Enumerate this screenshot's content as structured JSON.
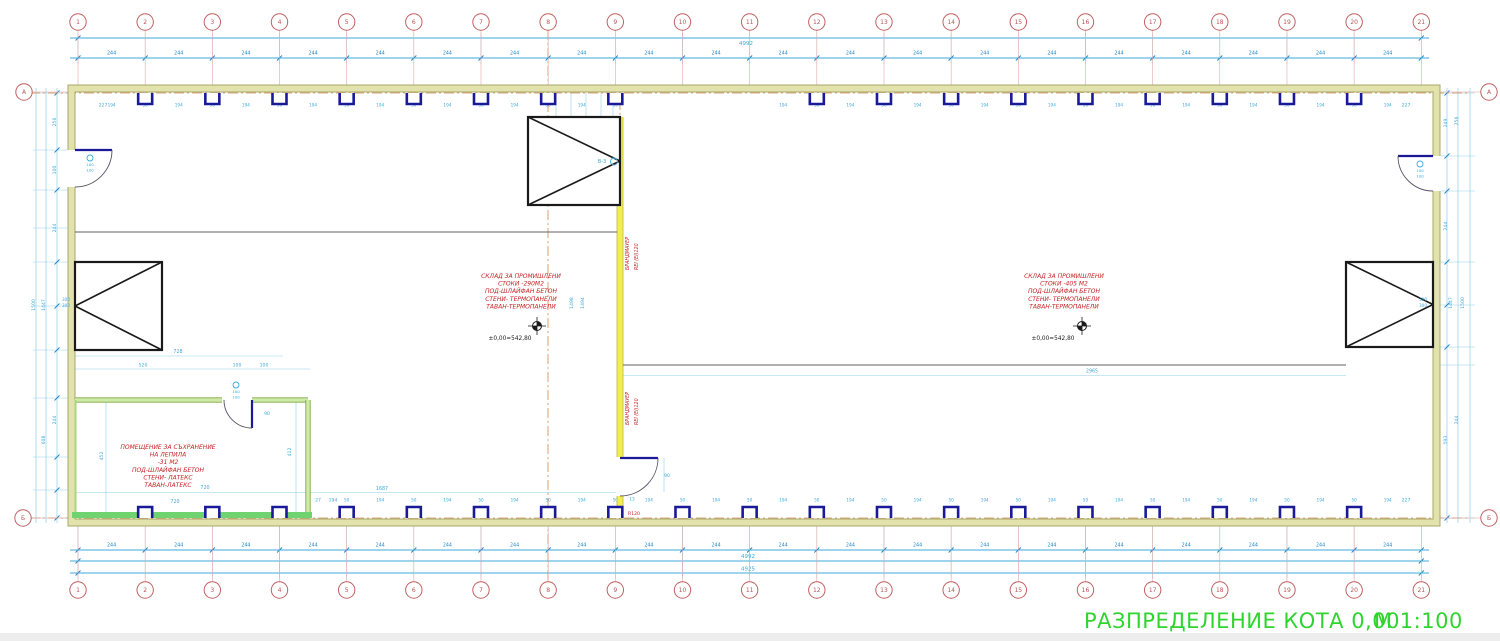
{
  "title": {
    "text": "РАЗПРЕДЕЛЕНИЕ КОТА 0,00",
    "scale": "М 1:100"
  },
  "grid": {
    "columns": [
      "1",
      "2",
      "3",
      "4",
      "5",
      "6",
      "7",
      "8",
      "9",
      "10",
      "11",
      "12",
      "13",
      "14",
      "15",
      "16",
      "17",
      "18",
      "19",
      "20",
      "21"
    ],
    "row_top": "А",
    "row_bottom": "Б"
  },
  "dims": {
    "bay": "244",
    "overall_top": "4992",
    "overall_bottom_1": "4992",
    "overall_bottom_2": "4925",
    "column_width": "50",
    "column_gap": "194",
    "misc": [
      {
        "t": "4992",
        "x": 746,
        "y": 45,
        "s": 5.5
      },
      {
        "t": "4992",
        "x": 748,
        "y": 558,
        "s": 5.5
      },
      {
        "t": "4925",
        "x": 748,
        "y": 570.5,
        "s": 5.5
      },
      {
        "t": "227",
        "x": 103,
        "y": 106.5,
        "s": 4.6
      },
      {
        "t": "227",
        "x": 1406,
        "y": 106.5,
        "s": 4.6
      },
      {
        "t": "227",
        "x": 1406,
        "y": 501.5,
        "s": 4.6
      },
      {
        "t": "27",
        "x": 318,
        "y": 501.5,
        "s": 4.6
      },
      {
        "t": "194",
        "x": 333,
        "y": 501.5,
        "s": 4.6
      },
      {
        "t": "1687",
        "x": 382,
        "y": 490,
        "s": 4.8
      },
      {
        "t": "720",
        "x": 175,
        "y": 503,
        "s": 4.8
      },
      {
        "t": "728",
        "x": 178,
        "y": 353,
        "s": 4.8
      },
      {
        "t": "520",
        "x": 143,
        "y": 366.5,
        "s": 4.6
      },
      {
        "t": "100",
        "x": 237,
        "y": 366.5,
        "s": 4.6
      },
      {
        "t": "100",
        "x": 264,
        "y": 366.5,
        "s": 4.6
      },
      {
        "t": "720",
        "x": 205,
        "y": 489,
        "s": 4.8
      },
      {
        "t": "90",
        "x": 267,
        "y": 415,
        "s": 4.6
      },
      {
        "t": "90",
        "x": 667,
        "y": 477,
        "s": 4.6
      },
      {
        "t": "13",
        "x": 632,
        "y": 500.5,
        "s": 4.2
      },
      {
        "t": "2965",
        "x": 1092,
        "y": 372.5,
        "s": 4.8
      },
      {
        "t": "R120",
        "x": 766,
        "y": 91,
        "s": 4.6,
        "c": "red"
      },
      {
        "t": "R120",
        "x": 634,
        "y": 515,
        "s": 4.6,
        "c": "red"
      },
      {
        "t": "1500",
        "x": 35,
        "y": 305,
        "r": -90
      },
      {
        "t": "1447",
        "x": 45,
        "y": 305,
        "r": -90
      },
      {
        "t": "256",
        "x": 56,
        "y": 122,
        "r": -90
      },
      {
        "t": "100",
        "x": 56,
        "y": 170,
        "r": -90
      },
      {
        "t": "244",
        "x": 56,
        "y": 228,
        "r": -90
      },
      {
        "t": "244",
        "x": 56,
        "y": 420,
        "r": -90
      },
      {
        "t": "608",
        "x": 45,
        "y": 440,
        "r": -90
      },
      {
        "t": "452",
        "x": 103,
        "y": 456,
        "r": -90
      },
      {
        "t": "412",
        "x": 291,
        "y": 452,
        "r": -90
      },
      {
        "t": "1498",
        "x": 573,
        "y": 303,
        "r": -90
      },
      {
        "t": "1494",
        "x": 584,
        "y": 303,
        "r": -90
      },
      {
        "t": "1464",
        "x": 1393,
        "y": 303,
        "r": -90
      },
      {
        "t": "1450",
        "x": 1416,
        "y": 303,
        "r": -90
      },
      {
        "t": "1447",
        "x": 1452,
        "y": 303,
        "r": -90
      },
      {
        "t": "1500",
        "x": 1464,
        "y": 303,
        "r": -90
      },
      {
        "t": "249",
        "x": 1447,
        "y": 123,
        "r": -90
      },
      {
        "t": "256",
        "x": 1458,
        "y": 121,
        "r": -90
      },
      {
        "t": "244",
        "x": 1447,
        "y": 226,
        "r": -90
      },
      {
        "t": "244",
        "x": 1458,
        "y": 420,
        "r": -90
      },
      {
        "t": "593",
        "x": 1447,
        "y": 440,
        "r": -90
      }
    ]
  },
  "rooms": [
    {
      "name": "warehouse-left",
      "x": 521,
      "y": 278,
      "lines": [
        "СКЛАД ЗА ПРОМИШЛЕНИ",
        "СТОКИ -290М2",
        "ПОД-ШЛАЙФАН БЕТОН",
        "СТЕНИ- ТЕРМОПАНЕЛИ",
        "ТАВАН-ТЕРМОПАНЕЛИ"
      ],
      "level": "±0,00=542,80",
      "level_x": 510,
      "level_y": 340,
      "marker_x": 537,
      "marker_y": 326
    },
    {
      "name": "warehouse-right",
      "x": 1064,
      "y": 278,
      "lines": [
        "СКЛАД ЗА ПРОМИШЛЕНИ",
        "СТОКИ -405 М2",
        "ПОД-ШЛАЙФАН БЕТОН",
        "СТЕНИ- ТЕРМОПАНЕЛИ",
        "ТАВАН-ТЕРМОПАНЕЛИ"
      ],
      "level": "±0,00=542,80",
      "level_x": 1053,
      "level_y": 340,
      "marker_x": 1082,
      "marker_y": 326
    },
    {
      "name": "storage-room",
      "x": 168,
      "y": 449,
      "lines": [
        "ПОМЕЩЕНИЕ ЗА СЪХРАНЕНИЕ",
        "НА ЛЕПИЛА",
        "-31 М2",
        "ПОД-ШЛАЙФАН БЕТОН",
        "СТЕНИ- ЛАТЕКС",
        "ТАВАН-ЛАТЕКС"
      ]
    }
  ],
  "firewall": {
    "label_line1": "БРАНДМАУЕР",
    "label_line2": "REI (EI)120"
  },
  "gates": {
    "side_label_1": "300",
    "side_label_2": "300",
    "top_label": "В-3"
  },
  "doors": {
    "label_1": "100",
    "label_2": "100"
  },
  "colors": {
    "dim": "#3fa9dc",
    "dim_light": "#8fd0e8",
    "dim_dark": "#2288cc",
    "red": "#c42222",
    "axis_circle": "#c06060",
    "wall_fill": "#e2e2ac",
    "wall_edge": "#a8a86a",
    "firewall_fill": "#f2ee52",
    "firewall_edge": "#b9b93e",
    "green_fill": "#cfe9a6",
    "green_edge": "#7daa45",
    "green_band": "#6fd46f",
    "navy": "#1a1a99",
    "orange": "#d28a50",
    "gray_line": "#606060",
    "title_green": "#2fd42f",
    "black": "#1a1a1a"
  }
}
